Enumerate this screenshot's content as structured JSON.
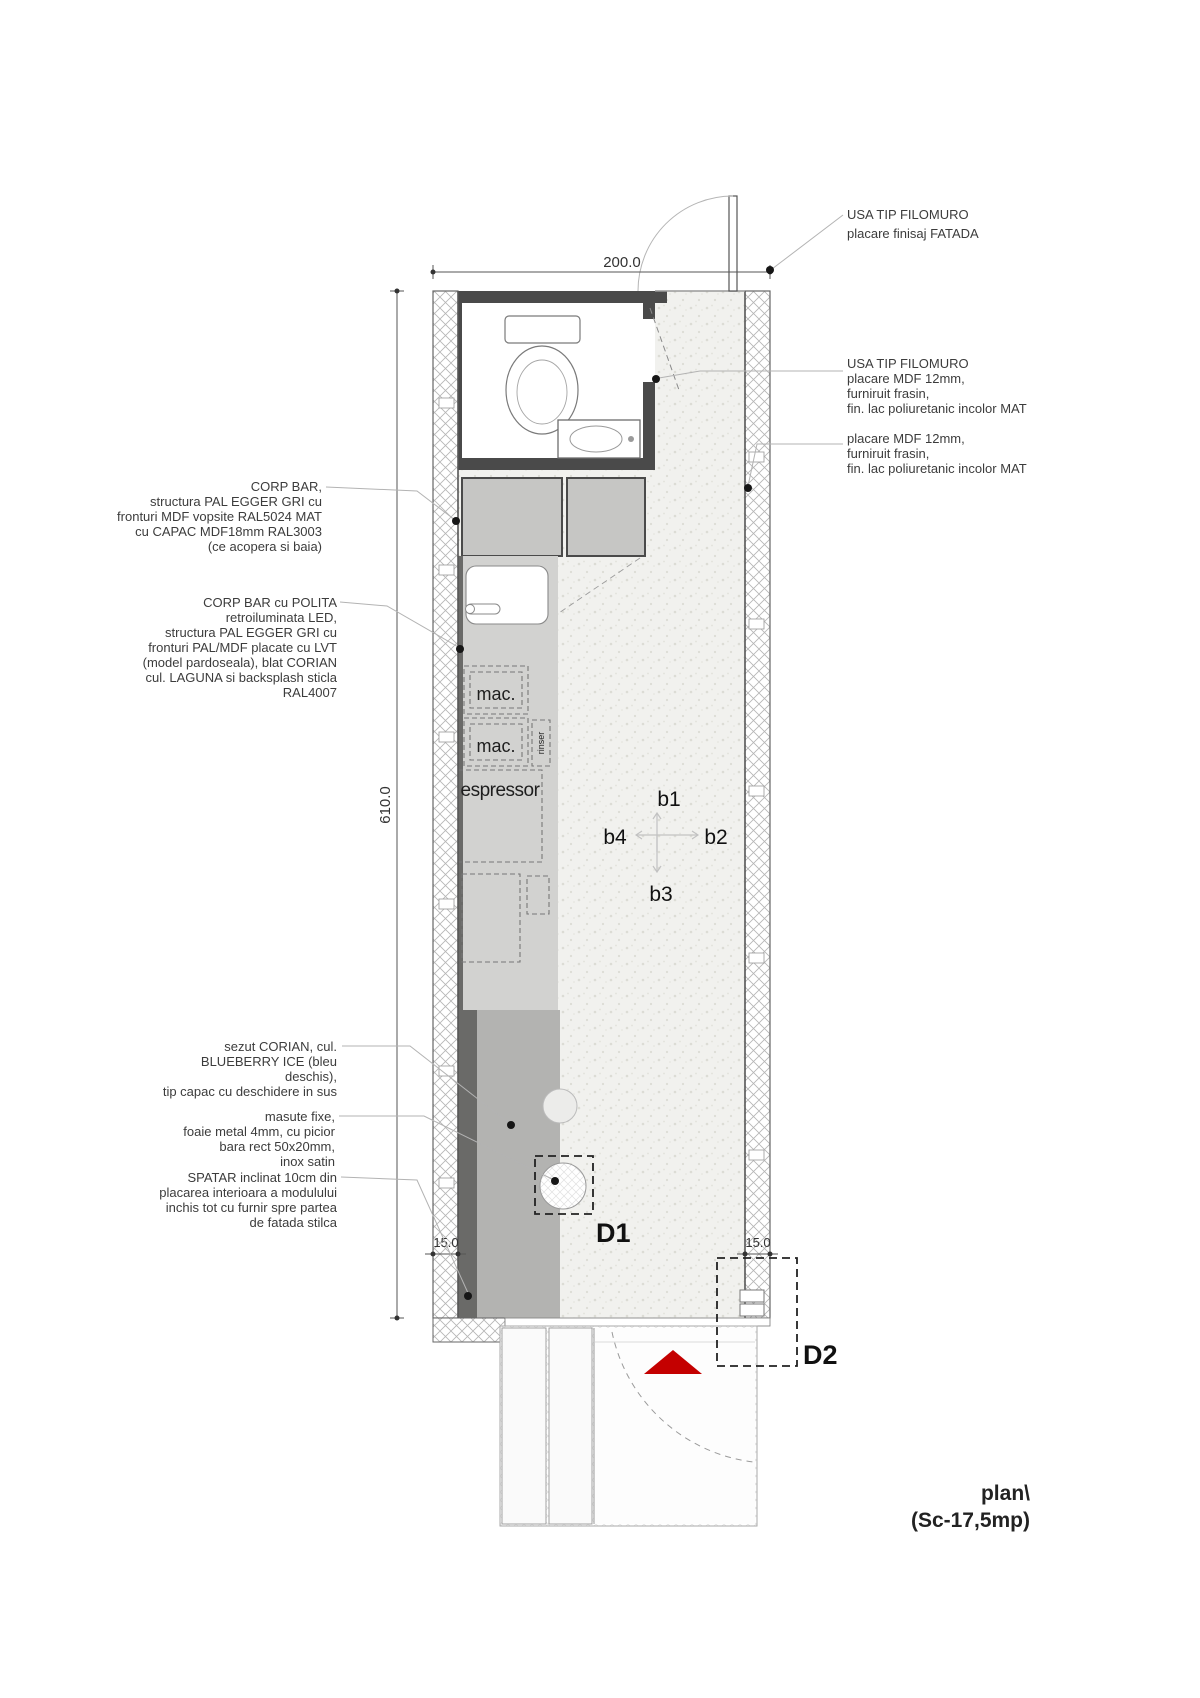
{
  "caption": {
    "line1": "plan\\",
    "line2": "(Sc-17,5mp)"
  },
  "dimensions": {
    "module_width": "200.0",
    "module_height": "610.0",
    "wall_left": "15.0",
    "wall_right": "15.0"
  },
  "annotations": {
    "door_facade": {
      "lines": [
        "USA TIP FILOMURO",
        "placare finisaj FATADA"
      ]
    },
    "door_mdf": {
      "lines": [
        "USA TIP FILOMURO",
        "placare MDF 12mm,",
        "furniruit frasin,",
        "fin. lac poliuretanic incolor MAT"
      ]
    },
    "cladding_mdf": {
      "lines": [
        "placare MDF 12mm,",
        "furniruit frasin,",
        "fin. lac poliuretanic incolor MAT"
      ]
    },
    "corp_bar": {
      "lines": [
        "CORP BAR,",
        "structura PAL EGGER GRI cu",
        "fronturi MDF vopsite RAL5024 MAT",
        "cu CAPAC MDF18mm RAL3003",
        "(ce acopera si baia)"
      ]
    },
    "corp_bar_polita": {
      "lines": [
        "CORP BAR cu POLITA",
        "retroiluminata LED,",
        "structura PAL EGGER GRI cu",
        "fronturi PAL/MDF placate cu LVT",
        "(model pardoseala), blat CORIAN",
        "cul. LAGUNA si backsplash sticla",
        "RAL4007"
      ]
    },
    "sezut": {
      "lines": [
        "sezut CORIAN, cul.",
        "BLUEBERRY ICE (bleu",
        "deschis),",
        "tip capac cu deschidere in sus"
      ]
    },
    "masute": {
      "lines": [
        "masute fixe,",
        "foaie metal 4mm, cu picior",
        "bara rect 50x20mm,",
        "inox satin"
      ]
    },
    "spatar": {
      "lines": [
        "SPATAR inclinat 10cm din",
        "placarea interioara a modulului",
        "inchis tot cu furnir spre partea",
        "de fatada stilca"
      ]
    }
  },
  "equipment": {
    "mac1": "mac.",
    "mac2": "mac.",
    "rinser": "rinser",
    "espressor": "espressor"
  },
  "markers": {
    "b1": "b1",
    "b2": "b2",
    "b3": "b3",
    "b4": "b4",
    "d1": "D1",
    "d2": "D2"
  },
  "colors": {
    "entry_arrow_red": "#c40000",
    "dark_wall": "#4a4a4a",
    "bench_seat": "#b3b3b1",
    "backrest": "#6a6a68",
    "counter": "#d2d2d0",
    "cabinet": "#c6c6c4",
    "floor": "#f1f1ee"
  }
}
